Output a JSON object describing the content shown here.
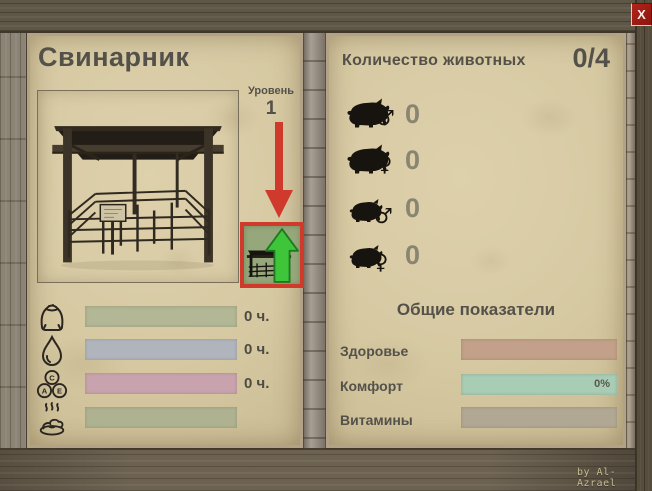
{
  "window": {
    "close_glyph": "X",
    "credit": "by Al-Azrael"
  },
  "pigsty": {
    "title": "Свинарник",
    "level_label": "Уровень",
    "level_value": "1",
    "resources": [
      {
        "name": "feed",
        "icon": "feed-sack-icon",
        "duration": "0 ч.",
        "bar_color": "#b2b795"
      },
      {
        "name": "water",
        "icon": "water-drop-icon",
        "duration": "0 ч.",
        "bar_color": "#b0b4bc"
      },
      {
        "name": "vitamins",
        "icon": "vitamins-icon",
        "duration": "0 ч.",
        "bar_color": "#c8a3ad"
      },
      {
        "name": "manure",
        "icon": "manure-icon",
        "duration": "",
        "bar_color": "#aeb291"
      }
    ],
    "vitamin_letters": {
      "c": "C",
      "a": "A",
      "e": "E"
    }
  },
  "animals": {
    "header_label": "Количество животных",
    "header_value": "0/4",
    "rows": [
      {
        "kind": "adult-male-pig",
        "gender": "♂",
        "count": "0"
      },
      {
        "kind": "adult-female-pig",
        "gender": "♀",
        "count": "0"
      },
      {
        "kind": "young-male-pig",
        "gender": "♂",
        "count": "0"
      },
      {
        "kind": "young-female-pig",
        "gender": "♀",
        "count": "0"
      }
    ]
  },
  "stats": {
    "title": "Общие показатели",
    "rows": [
      {
        "label": "Здоровье",
        "value": "",
        "bar_color": "#c2a089"
      },
      {
        "label": "Комфорт",
        "value": "0%",
        "bar_color": "#a8ccb4"
      },
      {
        "label": "Витамины",
        "value": "",
        "bar_color": "#b1a893"
      }
    ]
  },
  "colors": {
    "accent_red": "#cf3a2b",
    "upgrade_green": "#3fc53a",
    "paper": "#d6c9a2",
    "text": "#54514a"
  }
}
